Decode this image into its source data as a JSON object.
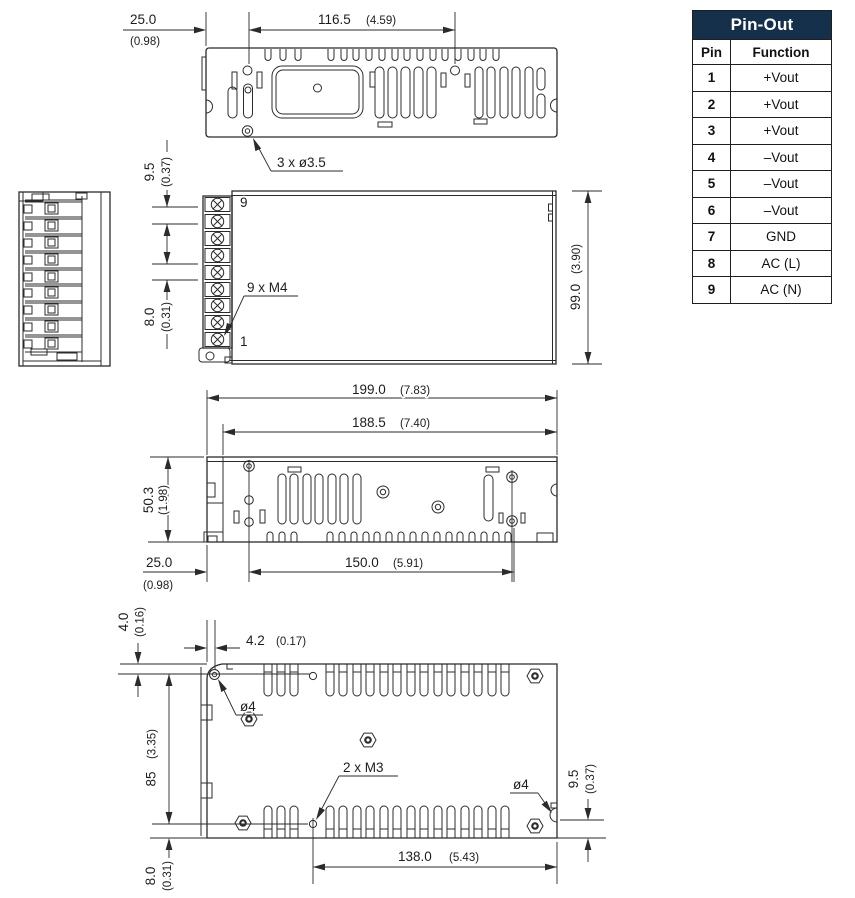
{
  "pinout": {
    "title": "Pin-Out",
    "col_pin": "Pin",
    "col_function": "Function",
    "rows": [
      {
        "pin": "1",
        "fn": "+Vout"
      },
      {
        "pin": "2",
        "fn": "+Vout"
      },
      {
        "pin": "3",
        "fn": "+Vout"
      },
      {
        "pin": "4",
        "fn": "–Vout"
      },
      {
        "pin": "5",
        "fn": "–Vout"
      },
      {
        "pin": "6",
        "fn": "–Vout"
      },
      {
        "pin": "7",
        "fn": "GND"
      },
      {
        "pin": "8",
        "fn": "AC (L)"
      },
      {
        "pin": "9",
        "fn": "AC (N)"
      }
    ]
  },
  "dims": {
    "top": {
      "m25": "25.0",
      "i25": "(0.98)",
      "m116": "116.5",
      "i116": "(4.59)",
      "holes": "3 x ø3.5"
    },
    "front": {
      "m95": "9.5",
      "i95": "(0.37)",
      "m80": "8.0",
      "i80": "(0.31)",
      "m99": "99.0",
      "i99": "(3.90)",
      "terminals": "9 x M4",
      "pin_top": "9",
      "pin_bottom": "1"
    },
    "side": {
      "m199": "199.0",
      "i199": "(7.83)",
      "m1885": "188.5",
      "i1885": "(7.40)",
      "m503": "50.3",
      "i503": "(1.98)",
      "m25": "25.0",
      "i25": "(0.98)",
      "m150": "150.0",
      "i150": "(5.91)"
    },
    "bottom": {
      "m40": "4.0",
      "i40": "(0.16)",
      "m42": "4.2",
      "i42": "(0.17)",
      "dia_left": "ø4",
      "m85": "85",
      "i85": "(3.35)",
      "m3": "2 x M3",
      "dia_right": "ø4",
      "m95": "9.5",
      "i95": "(0.37)",
      "m138": "138.0",
      "i138": "(5.43)",
      "m80": "8.0",
      "i80": "(0.31)"
    }
  },
  "colors": {
    "line": "#2b2b2b",
    "text": "#1d1d1d",
    "table_header_bg": "#14304a",
    "table_header_text": "#ffffff",
    "table_border": "#1f1f1f",
    "background": "#ffffff"
  }
}
